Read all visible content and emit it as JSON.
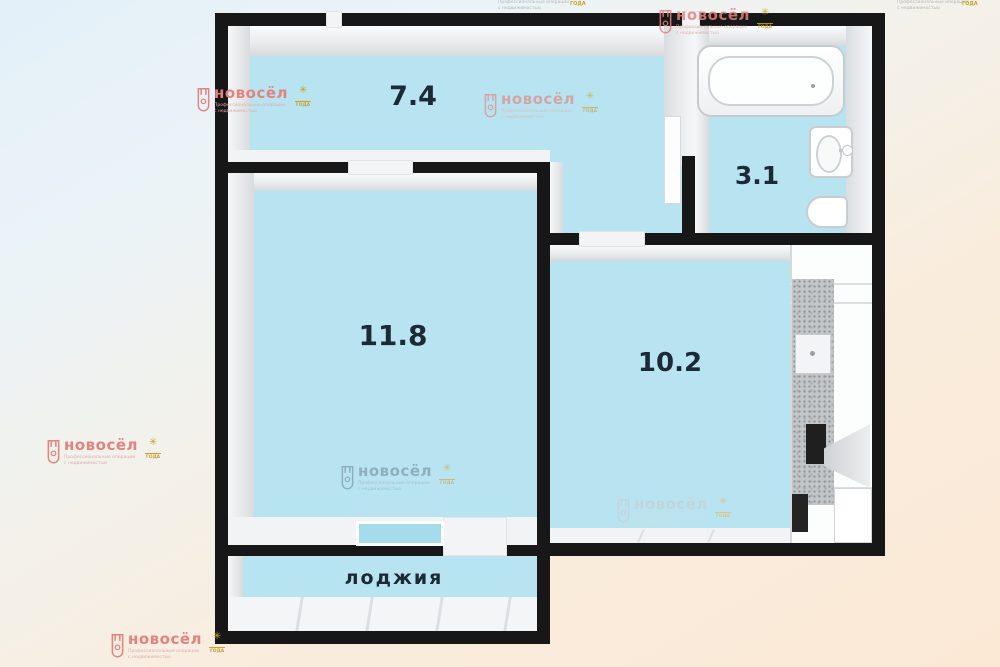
{
  "plan": {
    "rooms": [
      {
        "id": "hallway",
        "area_label": "7.4"
      },
      {
        "id": "bathroom",
        "area_label": "3.1"
      },
      {
        "id": "room",
        "area_label": "11.8"
      },
      {
        "id": "kitchen",
        "area_label": "10.2"
      },
      {
        "id": "loggia",
        "area_label": "лоджия"
      }
    ],
    "fixtures": [
      "bathtub",
      "washbasin",
      "toilet",
      "kitchen-counter",
      "kitchen-sink",
      "stove",
      "cooker-hood",
      "window",
      "doorway"
    ],
    "colors": {
      "wall": "#171717",
      "floor": "#b8e4f2",
      "background_blue": "#e3f0f9",
      "background_peach": "#fbe9d6",
      "label_text": "#1b2a36"
    }
  },
  "watermark": {
    "brand": "новосёл",
    "tagline_line1": "Профессиональные операции",
    "tagline_line2": "с недвижимостью",
    "badge_glyph": "✳",
    "badge_label": "ГОДА",
    "accent_red": "#e2837e",
    "badge_gold": "#c9a227"
  }
}
